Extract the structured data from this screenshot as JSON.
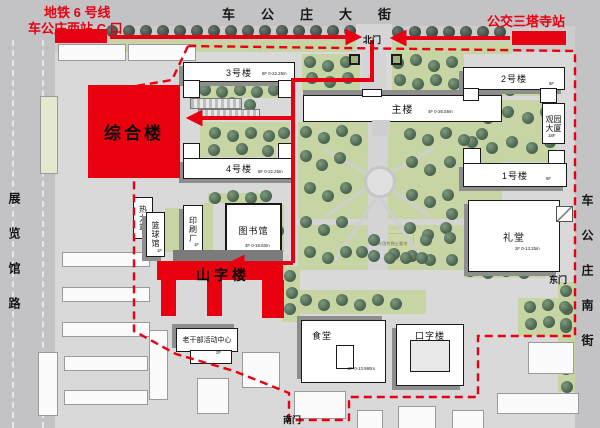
{
  "stations": {
    "metro_line": "地铁 6 号线",
    "metro_exit": "车公庄西站 C 口",
    "bus": "公交三塔寺站"
  },
  "streets": {
    "north": "车公庄大街",
    "west": "展览馆路",
    "east": "车公庄南街"
  },
  "gates": {
    "north": "北门",
    "east": "东门",
    "south": "南门"
  },
  "buildings": {
    "zonghe": {
      "label": "综合楼"
    },
    "shanzi": {
      "label": "山字楼"
    },
    "no3": {
      "label": "3号楼",
      "floors": "6F 0-22.25m"
    },
    "no4": {
      "label": "4号楼",
      "floors": "6F 0-22.25m"
    },
    "main": {
      "label": "主楼",
      "floors": "4F 0-26.55m"
    },
    "no2": {
      "label": "2号楼",
      "floors": "6F"
    },
    "no1": {
      "label": "1号楼",
      "floors": "6F"
    },
    "guanyuan": {
      "label": "观园大厦",
      "floors": "18F"
    },
    "library": {
      "label": "图书馆",
      "floors": "4F 0-19.50m"
    },
    "auditorium": {
      "label": "礼堂",
      "floors": "2F 0-13.25m"
    },
    "canteen": {
      "label": "食堂",
      "floors": "2F 0-13.990m"
    },
    "kouzi": {
      "label": "口字楼"
    },
    "heating": {
      "label": "热力站"
    },
    "basketball": {
      "label": "篮球馆",
      "floors": "1F"
    },
    "printing": {
      "label": "印刷厂",
      "floors": "1F"
    },
    "cadre": {
      "label": "老干部活动中心",
      "floors": "2F"
    },
    "cemetery": {
      "label": "外国传教士墓地"
    }
  },
  "colors": {
    "route_red": "#e60012",
    "building_red": "#e8000f",
    "lawn_green": "#c7d4a3",
    "road_gray": "#c3c3c5"
  },
  "map": {
    "street_trees": [
      [
        112,
        31
      ],
      [
        129,
        31
      ],
      [
        146,
        31
      ],
      [
        163,
        31
      ],
      [
        180,
        31
      ],
      [
        197,
        31
      ],
      [
        214,
        31
      ],
      [
        231,
        31
      ],
      [
        248,
        31
      ],
      [
        265,
        31
      ],
      [
        282,
        31
      ],
      [
        299,
        31
      ],
      [
        316,
        31
      ],
      [
        333,
        31
      ],
      [
        350,
        31
      ],
      [
        398,
        32
      ],
      [
        415,
        32
      ],
      [
        432,
        32
      ],
      [
        449,
        32
      ],
      [
        466,
        32
      ],
      [
        483,
        32
      ],
      [
        500,
        32
      ]
    ],
    "campus_trees": [
      [
        205,
        90
      ],
      [
        222,
        92
      ],
      [
        240,
        90
      ],
      [
        257,
        92
      ],
      [
        274,
        90
      ],
      [
        196,
        103
      ],
      [
        214,
        105
      ],
      [
        232,
        103
      ],
      [
        250,
        105
      ],
      [
        215,
        133
      ],
      [
        233,
        136
      ],
      [
        251,
        133
      ],
      [
        269,
        136
      ],
      [
        284,
        133
      ],
      [
        214,
        150
      ],
      [
        242,
        149
      ],
      [
        268,
        151
      ],
      [
        310,
        62
      ],
      [
        328,
        66
      ],
      [
        346,
        62
      ],
      [
        312,
        78
      ],
      [
        330,
        82
      ],
      [
        348,
        78
      ],
      [
        398,
        63
      ],
      [
        416,
        60
      ],
      [
        434,
        66
      ],
      [
        452,
        62
      ],
      [
        400,
        80
      ],
      [
        418,
        84
      ],
      [
        436,
        80
      ],
      [
        454,
        84
      ],
      [
        492,
        88
      ],
      [
        510,
        90
      ],
      [
        528,
        88
      ],
      [
        544,
        90
      ],
      [
        468,
        112
      ],
      [
        488,
        118
      ],
      [
        508,
        112
      ],
      [
        528,
        118
      ],
      [
        546,
        112
      ],
      [
        472,
        142
      ],
      [
        492,
        148
      ],
      [
        512,
        142
      ],
      [
        532,
        148
      ],
      [
        550,
        142
      ],
      [
        306,
        132
      ],
      [
        324,
        138
      ],
      [
        342,
        131
      ],
      [
        356,
        140
      ],
      [
        306,
        156
      ],
      [
        322,
        165
      ],
      [
        340,
        158
      ],
      [
        310,
        188
      ],
      [
        328,
        196
      ],
      [
        346,
        188
      ],
      [
        306,
        222
      ],
      [
        324,
        230
      ],
      [
        342,
        222
      ],
      [
        310,
        252
      ],
      [
        328,
        258
      ],
      [
        346,
        252
      ],
      [
        410,
        134
      ],
      [
        428,
        140
      ],
      [
        446,
        133
      ],
      [
        464,
        140
      ],
      [
        482,
        134
      ],
      [
        412,
        162
      ],
      [
        430,
        170
      ],
      [
        450,
        162
      ],
      [
        412,
        195
      ],
      [
        430,
        202
      ],
      [
        448,
        195
      ],
      [
        410,
        228
      ],
      [
        428,
        235
      ],
      [
        446,
        228
      ],
      [
        412,
        256
      ],
      [
        430,
        260
      ],
      [
        362,
        252
      ],
      [
        394,
        254
      ],
      [
        215,
        198
      ],
      [
        233,
        196
      ],
      [
        251,
        198
      ],
      [
        266,
        196
      ],
      [
        276,
        214
      ],
      [
        278,
        231
      ],
      [
        276,
        248
      ],
      [
        374,
        240
      ],
      [
        374,
        256
      ],
      [
        390,
        258
      ],
      [
        406,
        258
      ],
      [
        422,
        258
      ],
      [
        426,
        240
      ],
      [
        452,
        214
      ],
      [
        450,
        238
      ],
      [
        452,
        260
      ],
      [
        551,
        214
      ],
      [
        549,
        238
      ],
      [
        551,
        262
      ],
      [
        470,
        271
      ],
      [
        488,
        273
      ],
      [
        506,
        271
      ],
      [
        524,
        273
      ],
      [
        566,
        291
      ],
      [
        567,
        309
      ],
      [
        566,
        327
      ],
      [
        567,
        349
      ],
      [
        566,
        369
      ],
      [
        567,
        387
      ],
      [
        530,
        307
      ],
      [
        548,
        305
      ],
      [
        565,
        307
      ],
      [
        531,
        324
      ],
      [
        549,
        322
      ],
      [
        566,
        324
      ],
      [
        290,
        276
      ],
      [
        292,
        293
      ],
      [
        290,
        309
      ],
      [
        306,
        300
      ],
      [
        324,
        305
      ],
      [
        342,
        300
      ],
      [
        360,
        305
      ],
      [
        378,
        300
      ],
      [
        396,
        304
      ]
    ]
  }
}
